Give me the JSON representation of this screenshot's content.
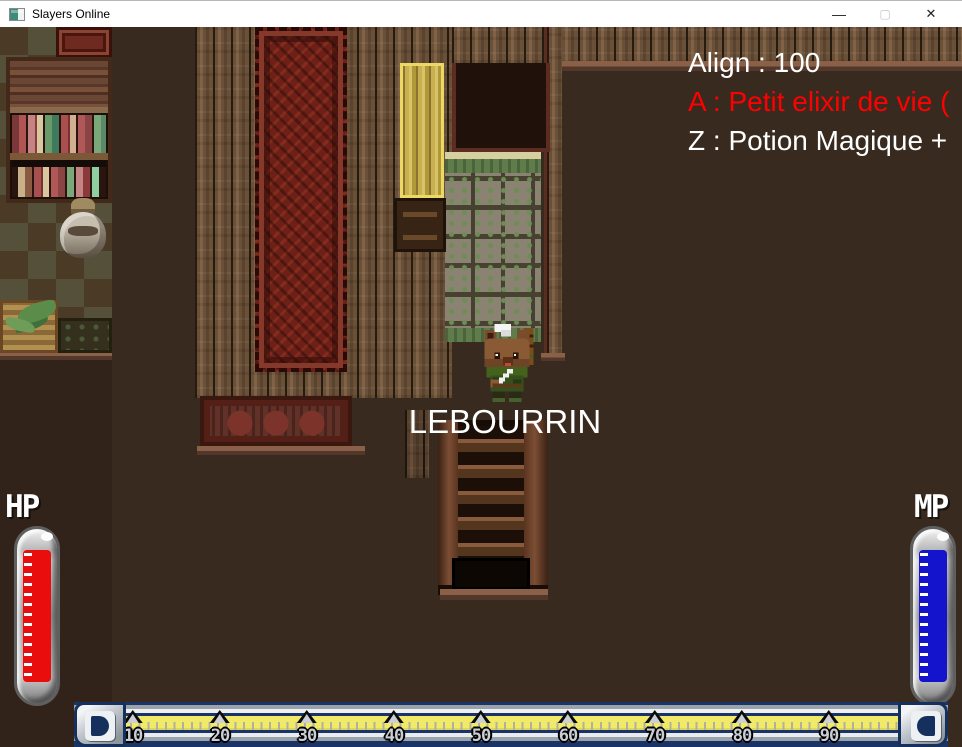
{
  "window": {
    "title": "Slayers Online",
    "minimize_glyph": "—",
    "maximize_glyph": "▢",
    "close_glyph": "✕"
  },
  "hud": {
    "align": "Align : 100",
    "slot_a": "A : Petit elixir de vie (",
    "slot_z": "Z : Potion Magique +",
    "player_name": "LEBOURRIN",
    "hp_label": "HP",
    "mp_label": "MP",
    "xp_ruler": {
      "marks": [
        "10",
        "20",
        "30",
        "40",
        "50",
        "60",
        "70",
        "80",
        "90"
      ]
    }
  },
  "palette": {
    "slot_a_text": "#ff0000",
    "hud_text": "#ffffff",
    "hp_fill": "#ea0d0d",
    "mp_fill": "#1414cc",
    "xp_band": "#f0ea68",
    "xp_frame": "#1a3468",
    "titlebar_bg": "#ffffff"
  }
}
